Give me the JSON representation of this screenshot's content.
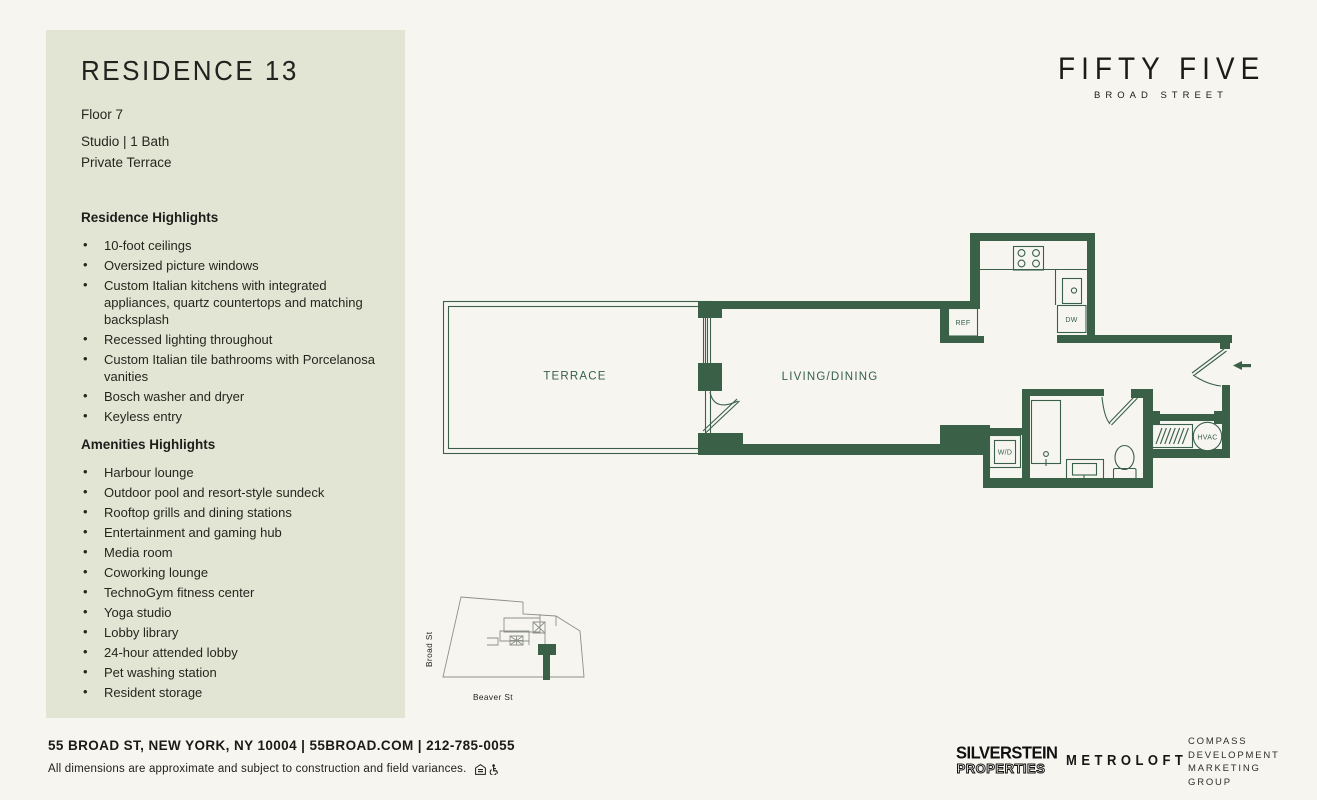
{
  "colors": {
    "background": "#f7f5f0",
    "sidebar": "#e3e5d4",
    "wall_green": "#3a6148",
    "text_dark": "#1d1d1b"
  },
  "sidebar": {
    "title": "RESIDENCE 13",
    "floor": "Floor 7",
    "layout": "Studio  |  1 Bath",
    "feature": "Private Terrace",
    "residence_highlights": {
      "heading": "Residence Highlights",
      "items": [
        "10-foot ceilings",
        "Oversized picture windows",
        "Custom Italian kitchens with integrated appliances, quartz countertops and matching backsplash",
        "Recessed lighting throughout",
        "Custom Italian tile bathrooms with Porcelanosa vanities",
        "Bosch washer and dryer",
        "Keyless entry"
      ]
    },
    "amenities_highlights": {
      "heading": "Amenities Highlights",
      "items": [
        "Harbour lounge",
        "Outdoor pool and resort-style sundeck",
        "Rooftop grills and dining stations",
        "Entertainment and gaming hub",
        "Media room",
        "Coworking lounge",
        "TechnoGym fitness center",
        "Yoga studio",
        "Lobby library",
        "24-hour attended lobby",
        "Pet washing station",
        "Resident storage"
      ]
    }
  },
  "brand": {
    "name": "FIFTY FIVE",
    "sub": "BROAD STREET"
  },
  "floorplan": {
    "labels": {
      "terrace": "TERRACE",
      "living": "LIVING/DINING",
      "ref": "REF",
      "dw": "DW",
      "wd": "W/D",
      "hvac": "HVAC"
    }
  },
  "sitemap": {
    "street_left": "Broad St",
    "street_bottom": "Beaver St"
  },
  "footer": {
    "address": "55 BROAD ST, NEW YORK, NY 10004  |  55BROAD.COM  |  212-785-0055",
    "disclaimer": "All dimensions are approximate and subject to construction and field variances.",
    "icons": [
      "equal-housing-icon",
      "accessibility-icon"
    ]
  },
  "logos": {
    "silverstein_line1": "SILVERSTEIN",
    "silverstein_line2": "PROPERTIES",
    "metroloft": "METROLOFT",
    "compass_lines": [
      "COMPASS",
      "DEVELOPMENT",
      "MARKETING",
      "GROUP"
    ]
  }
}
